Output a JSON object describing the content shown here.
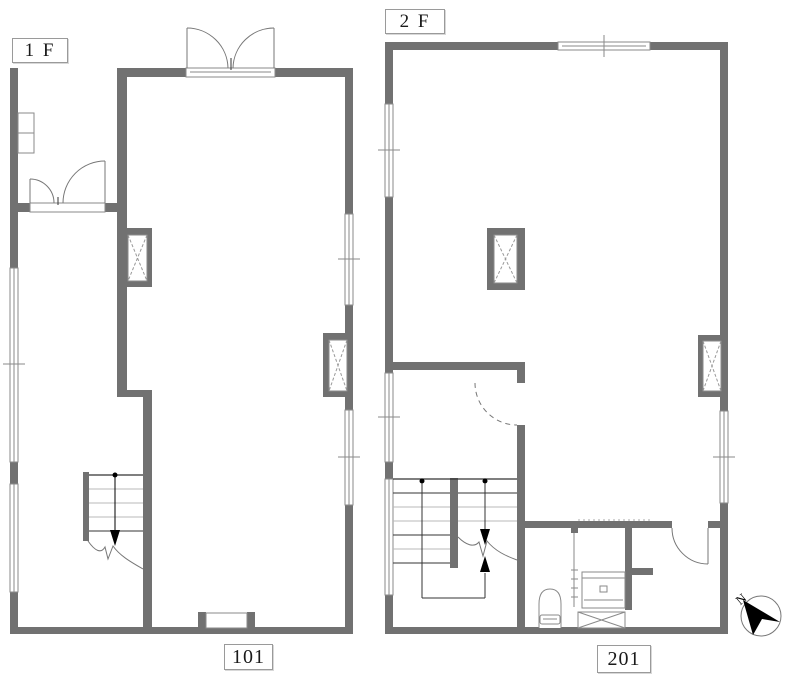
{
  "document": {
    "type": "architectural-floor-plan",
    "floors_shown": 2
  },
  "colors": {
    "wall": "#717171",
    "background": "#ffffff",
    "thin_line": "#555555",
    "light_tread": "#b8b8b8",
    "arrow_black": "#000000"
  },
  "floor1": {
    "label": "1 F",
    "room_number": "101"
  },
  "floor2": {
    "label": "2 F",
    "room_number": "201"
  },
  "compass": {
    "letter": "N",
    "direction": "northwest-pointing-dart"
  },
  "icons": {
    "shaft": "x-box-icon",
    "north": "north-arrow-icon",
    "toilet": "toilet-icon",
    "vanity": "sink-counter-icon",
    "stairs": "stair-run-with-direction-arrows"
  }
}
